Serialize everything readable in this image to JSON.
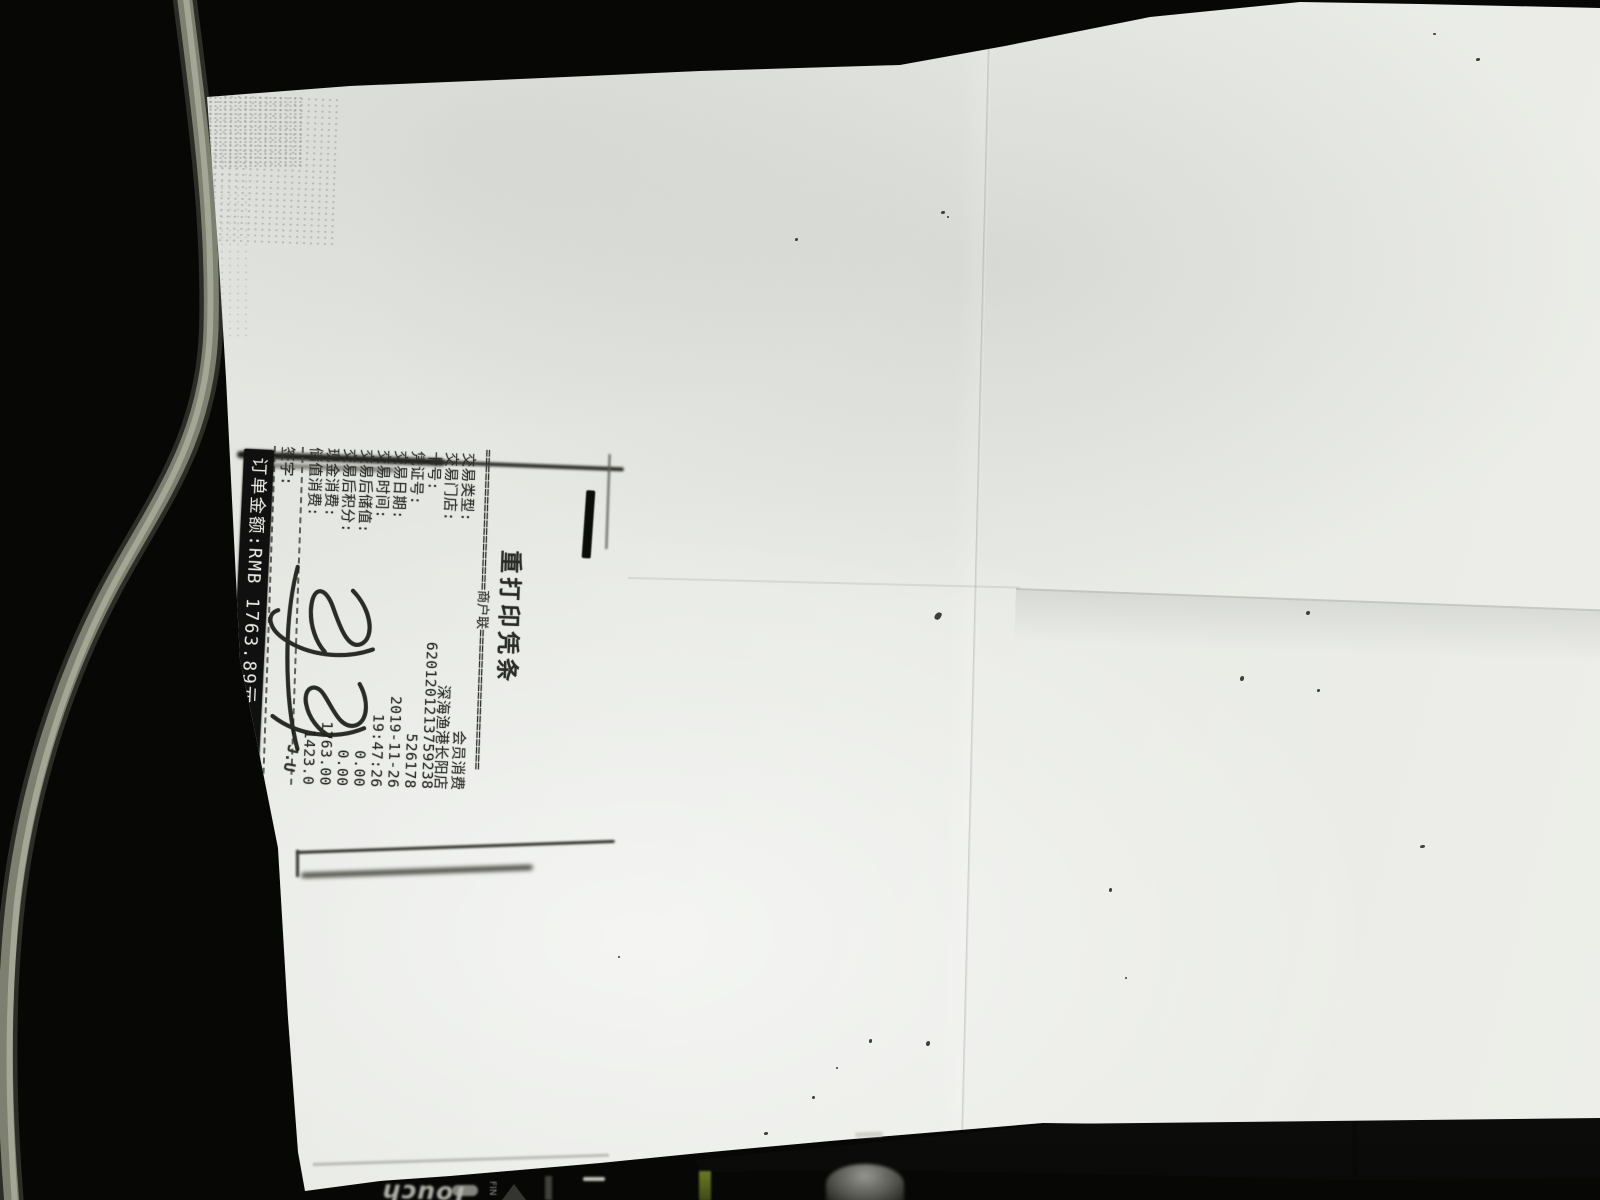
{
  "receipt": {
    "title": "重打印凭条",
    "merchant_copy_line": "==================商户联==================",
    "rows": [
      {
        "label": "交易类型:",
        "value": "会员消费"
      },
      {
        "label": "交易门店:",
        "value": "深海渔港长阳店"
      },
      {
        "label": "卡号:",
        "value": "6201201213759238"
      },
      {
        "label": "凭证号:",
        "value": "526178"
      },
      {
        "label": "交易日期:",
        "value": "2019-11-26"
      },
      {
        "label": "交易时间:",
        "value": "19:47:26"
      },
      {
        "label": "交易后储值:",
        "value": "0.00"
      },
      {
        "label": "交易后积分:",
        "value": "0.00"
      },
      {
        "label": "现金消费:",
        "value": "1763.00"
      },
      {
        "label": "储值消费:",
        "value": "1423.0"
      }
    ],
    "signature_label": "签字:",
    "total_band_text": "订单金额:RMB 1763.89元",
    "corner_fragment": "J.U"
  },
  "background_objects": {
    "marker_brand_text": "Touch",
    "marker_small_text": "FIN"
  },
  "colors": {
    "paper": "#e7e9e4",
    "background": "#070706",
    "toner_text": "#2b2c27",
    "band_background": "#101010",
    "band_text": "#f0f0ea"
  }
}
